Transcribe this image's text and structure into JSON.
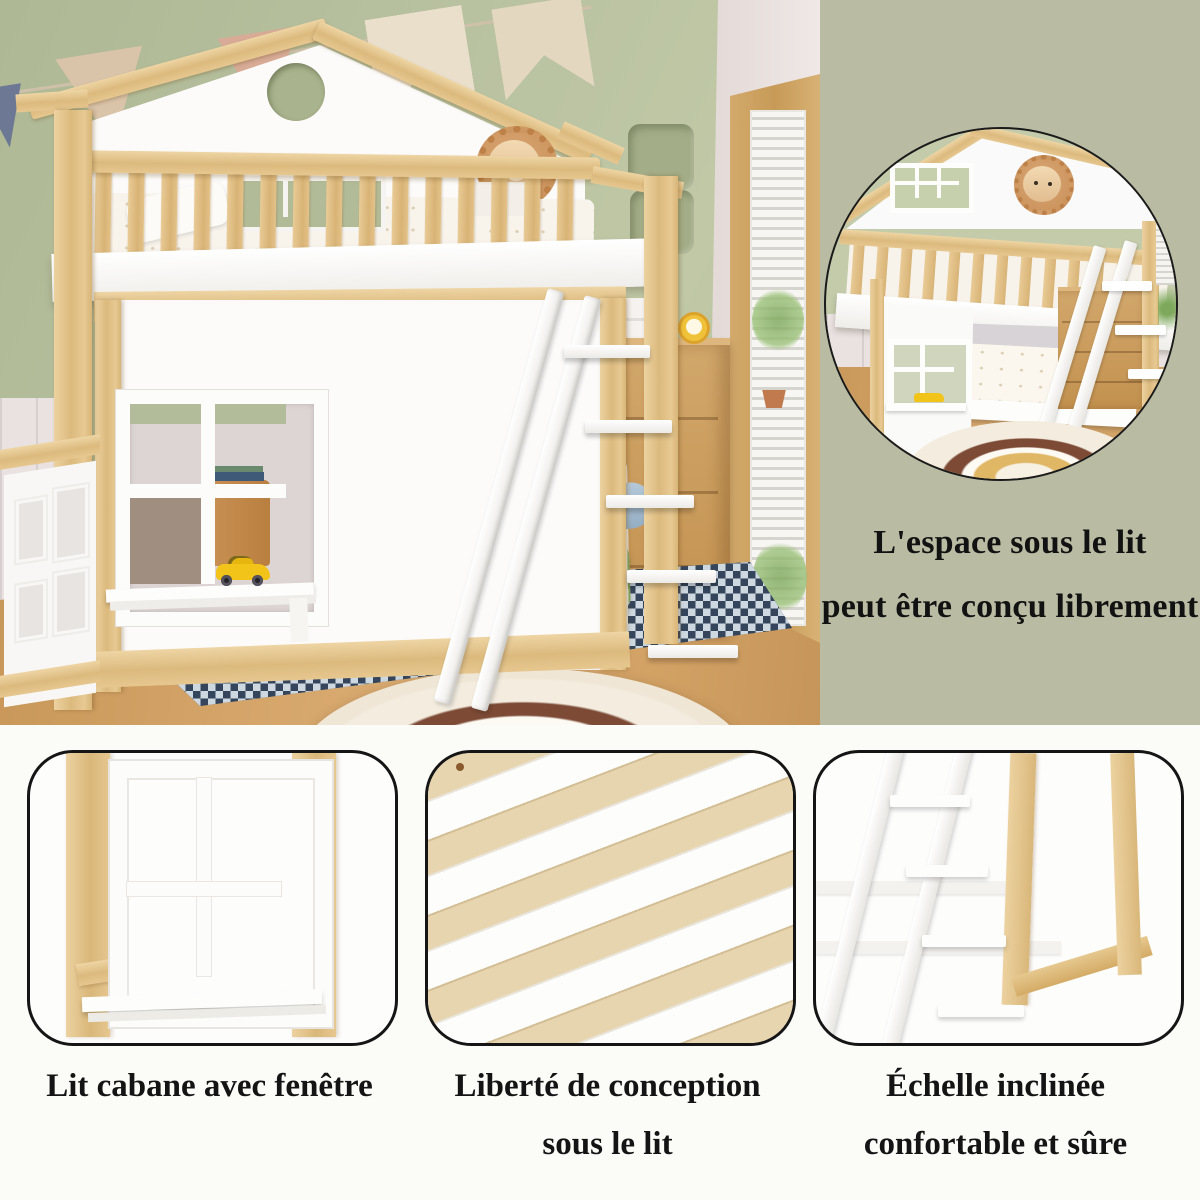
{
  "side_panel": {
    "background": "#b9bca3",
    "caption": {
      "line1": "L'espace sous le lit",
      "line2": "peut être conçu librement"
    }
  },
  "features": [
    {
      "id": "window",
      "caption": {
        "line1": "Lit cabane avec fenêtre",
        "line2": ""
      }
    },
    {
      "id": "slats",
      "caption": {
        "line1": "Liberté de conception",
        "line2": "sous le lit"
      }
    },
    {
      "id": "ladder",
      "caption": {
        "line1": "Échelle inclinée",
        "line2": "confortable et sûre"
      }
    }
  ],
  "palette": {
    "sage_panel": "#b9bca3",
    "wall_green": "#b6bf9f",
    "wood_light": "#e6c78f",
    "wood_mid": "#c89a5e",
    "floor_wood": "#cfa26b",
    "paint_white": "#fbfafa",
    "toy_car_yellow": "#f2c318",
    "rug_navy": "#35465c",
    "text": "#141414",
    "bottom_background": "#fbfbf8"
  }
}
